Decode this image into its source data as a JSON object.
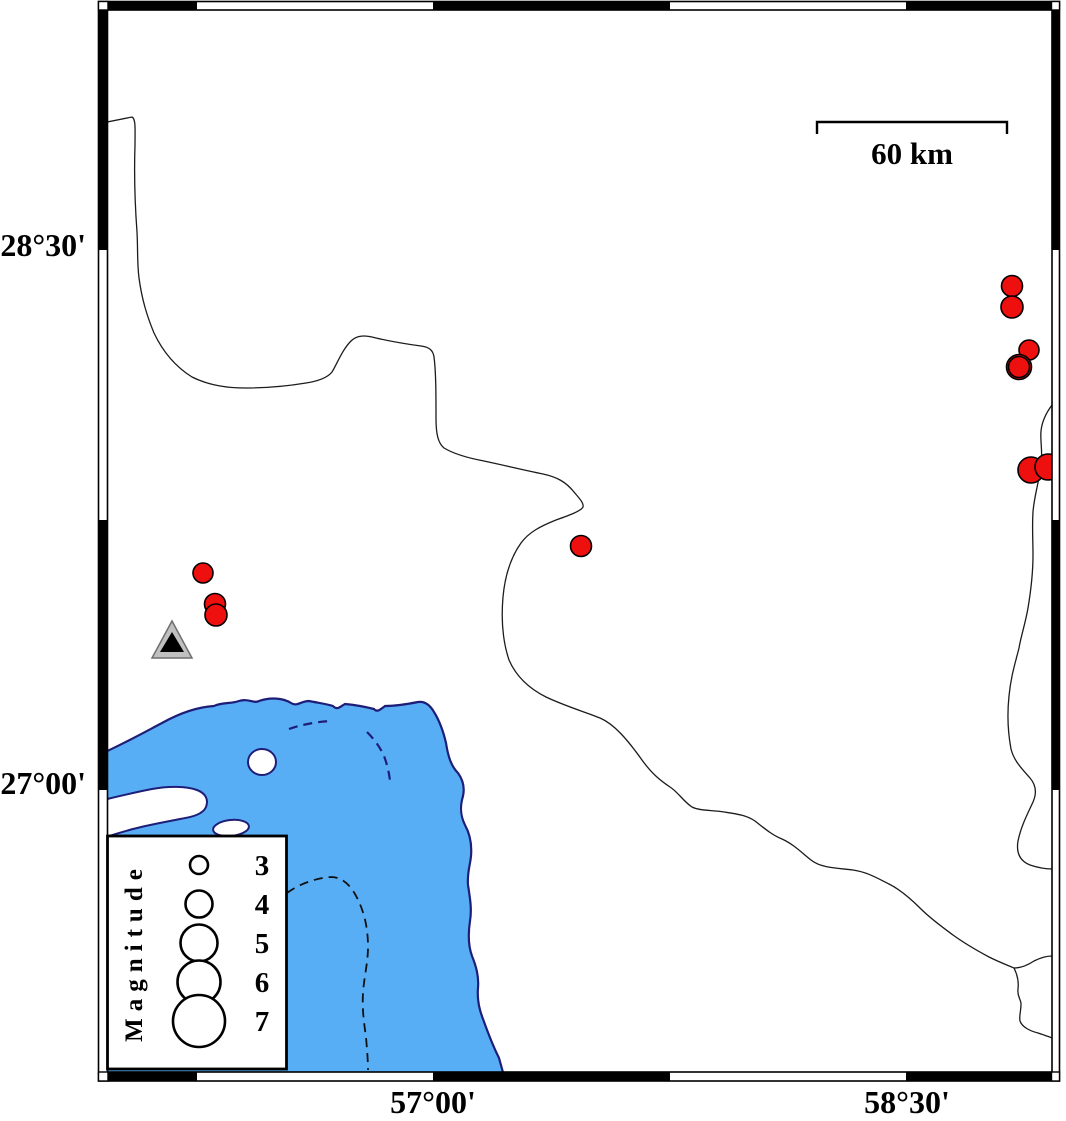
{
  "axis": {
    "left_labels": [
      {
        "label": "28°30'"
      },
      {
        "label": "27°00'"
      }
    ],
    "bottom_labels": [
      {
        "label": "57°00'"
      },
      {
        "label": "58°30'"
      }
    ]
  },
  "scale_bar": {
    "label": "60 km",
    "length_km": 60
  },
  "legend": {
    "title": "Magnitude",
    "items": [
      {
        "magnitude": "3",
        "radius": 9
      },
      {
        "magnitude": "4",
        "radius": 13.5
      },
      {
        "magnitude": "5",
        "radius": 18.5
      },
      {
        "magnitude": "6",
        "radius": 21.5
      },
      {
        "magnitude": "7",
        "radius": 26
      }
    ]
  },
  "markers": {
    "earthquakes": [
      {
        "cx": 203,
        "cy": 573,
        "r": 10
      },
      {
        "cx": 215,
        "cy": 604,
        "r": 10.5
      },
      {
        "cx": 216,
        "cy": 615,
        "r": 11
      },
      {
        "cx": 581,
        "cy": 546,
        "r": 10.5
      },
      {
        "cx": 1012,
        "cy": 286,
        "r": 10.5
      },
      {
        "cx": 1012,
        "cy": 307,
        "r": 11
      },
      {
        "cx": 1029,
        "cy": 350,
        "r": 10
      },
      {
        "cx": 1019,
        "cy": 367,
        "r": 12.5
      },
      {
        "cx": 1019,
        "cy": 367,
        "r": 10.5
      },
      {
        "cx": 1031,
        "cy": 470,
        "r": 13
      },
      {
        "cx": 1048,
        "cy": 467,
        "r": 13
      }
    ],
    "station_triangle": {
      "x": 172,
      "y": 644
    }
  },
  "colors": {
    "water": "#58aef5",
    "coastline": "#1e1e78",
    "earthquake": "#ee0f0f",
    "triangle_fill": "#c0c0c0",
    "frame": "#000000"
  }
}
